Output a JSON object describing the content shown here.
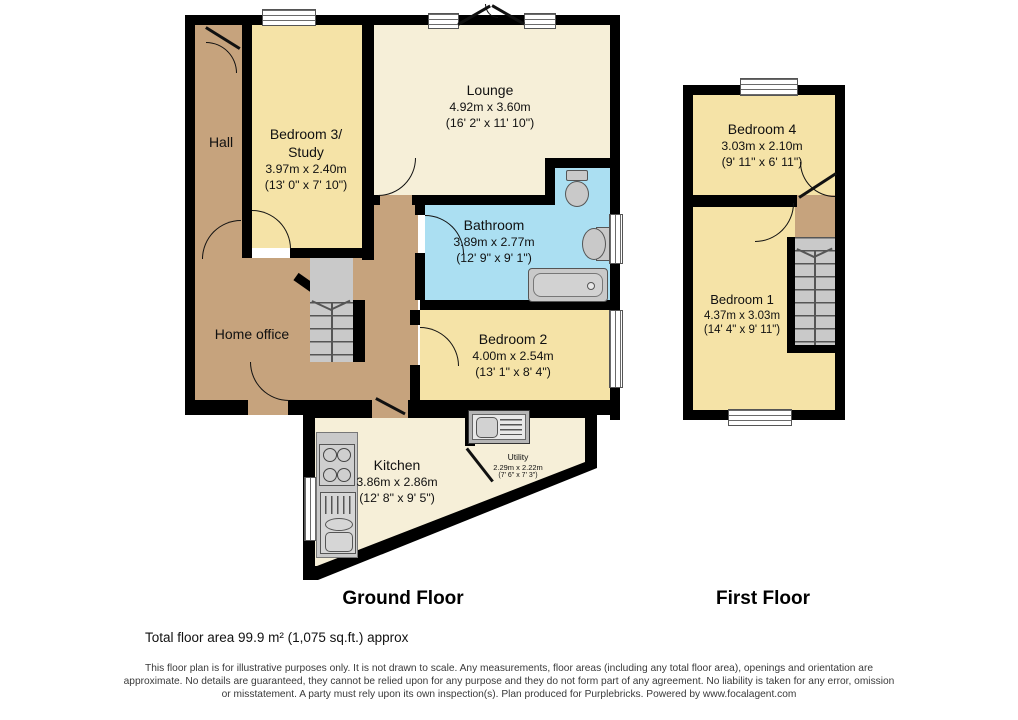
{
  "colors": {
    "wall": "#000000",
    "yellow_room": "#f5e3a7",
    "cream_room": "#f6efd8",
    "blue_room": "#abdff2",
    "brown_room": "#c6a37d",
    "fixture_gray": "#c9c9c9"
  },
  "rooms": {
    "hall": {
      "name": "Hall"
    },
    "bedroom3": {
      "name": "Bedroom 3/",
      "name2": "Study",
      "metric": "3.97m x 2.40m",
      "imperial": "(13' 0\" x 7' 10\")"
    },
    "lounge": {
      "name": "Lounge",
      "metric": "4.92m x 3.60m",
      "imperial": "(16' 2\" x 11' 10\")"
    },
    "bathroom": {
      "name": "Bathroom",
      "metric": "3.89m x 2.77m",
      "imperial": "(12' 9\" x 9' 1\")"
    },
    "home_office": {
      "name": "Home office"
    },
    "bedroom2": {
      "name": "Bedroom 2",
      "metric": "4.00m x 2.54m",
      "imperial": "(13' 1\" x 8' 4\")"
    },
    "kitchen": {
      "name": "Kitchen",
      "metric": "3.86m x 2.86m",
      "imperial": "(12' 8\" x 9' 5\")"
    },
    "utility": {
      "name": "Utility",
      "metric": "2.29m x 2.22m",
      "imperial": "(7' 6\" x 7' 3\")"
    },
    "bedroom4": {
      "name": "Bedroom 4",
      "metric": "3.03m x 2.10m",
      "imperial": "(9' 11\" x 6' 11\")"
    },
    "bedroom1": {
      "name": "Bedroom 1",
      "metric": "4.37m x 3.03m",
      "imperial": "(14' 4\" x 9' 11\")"
    }
  },
  "floor_titles": {
    "ground": "Ground Floor",
    "first": "First Floor"
  },
  "footer": {
    "total_area": "Total floor area 99.9 m² (1,075 sq.ft.) approx",
    "disclaimer_line1": "This floor plan is for illustrative purposes only. It is not drawn to scale. Any measurements, floor areas (including any total floor area), openings and orientation are",
    "disclaimer_line2": "approximate. No details are guaranteed, they cannot be relied upon for any purpose and they do not form part of any agreement. No liability is taken for any error, omission",
    "disclaimer_line3": "or misstatement. A party must rely upon its own inspection(s). Plan produced for Purplebricks. Powered by www.focalagent.com"
  }
}
